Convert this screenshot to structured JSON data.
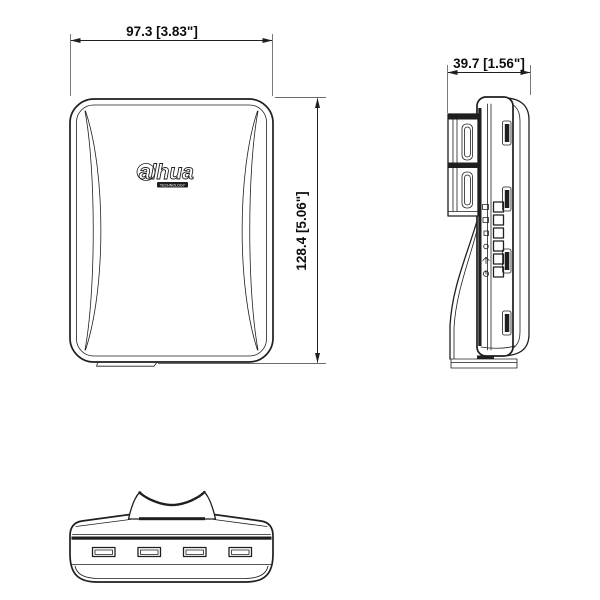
{
  "drawing": {
    "dimensions": {
      "width": "97.3 [3.83\"]",
      "height": "128.4 [5.06\"]",
      "depth": "39.7 [1.56\"]"
    },
    "logo": {
      "brand": "alhua",
      "subtext": "TECHNOLOGY"
    },
    "indicators": {
      "led_count": 6
    },
    "colors": {
      "line": "#1f1f1f",
      "extension_line": "#6b6b6b",
      "background": "#ffffff"
    }
  }
}
